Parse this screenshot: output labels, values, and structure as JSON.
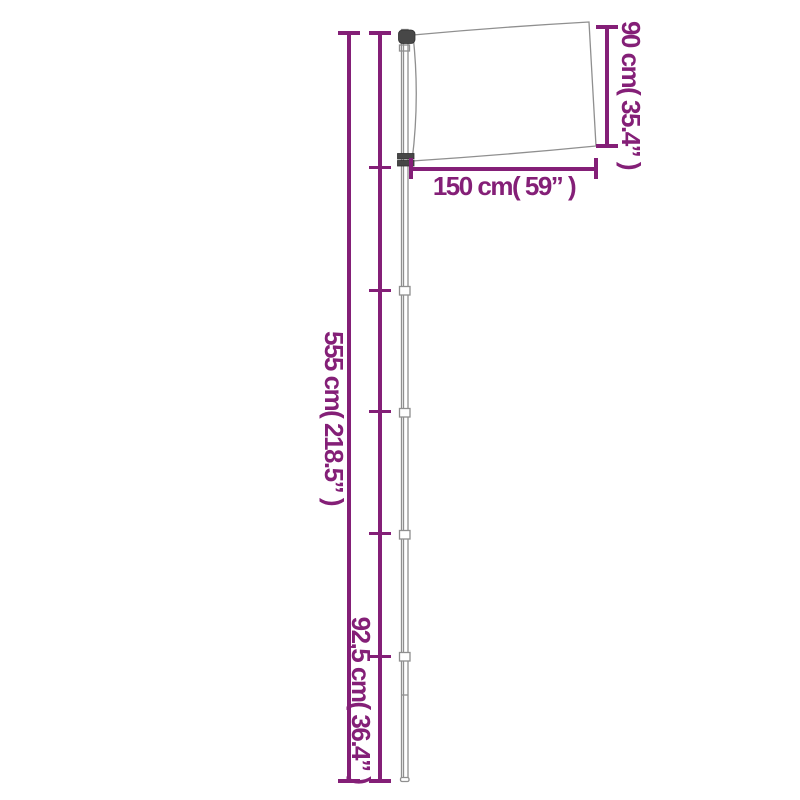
{
  "diagram": {
    "description": "Telescopic flagpole with flag - product dimension diagram",
    "accent_color": "#841f77",
    "line_color": "#8f8f8f",
    "metal_color": "#474747",
    "labels": {
      "pole_height": "555 cm( 218.5” )",
      "bottom_segment": "92,5 cm( 36.4” )",
      "flag_height": "90 cm( 35.4” )",
      "flag_width": "150 cm( 59” )"
    }
  }
}
